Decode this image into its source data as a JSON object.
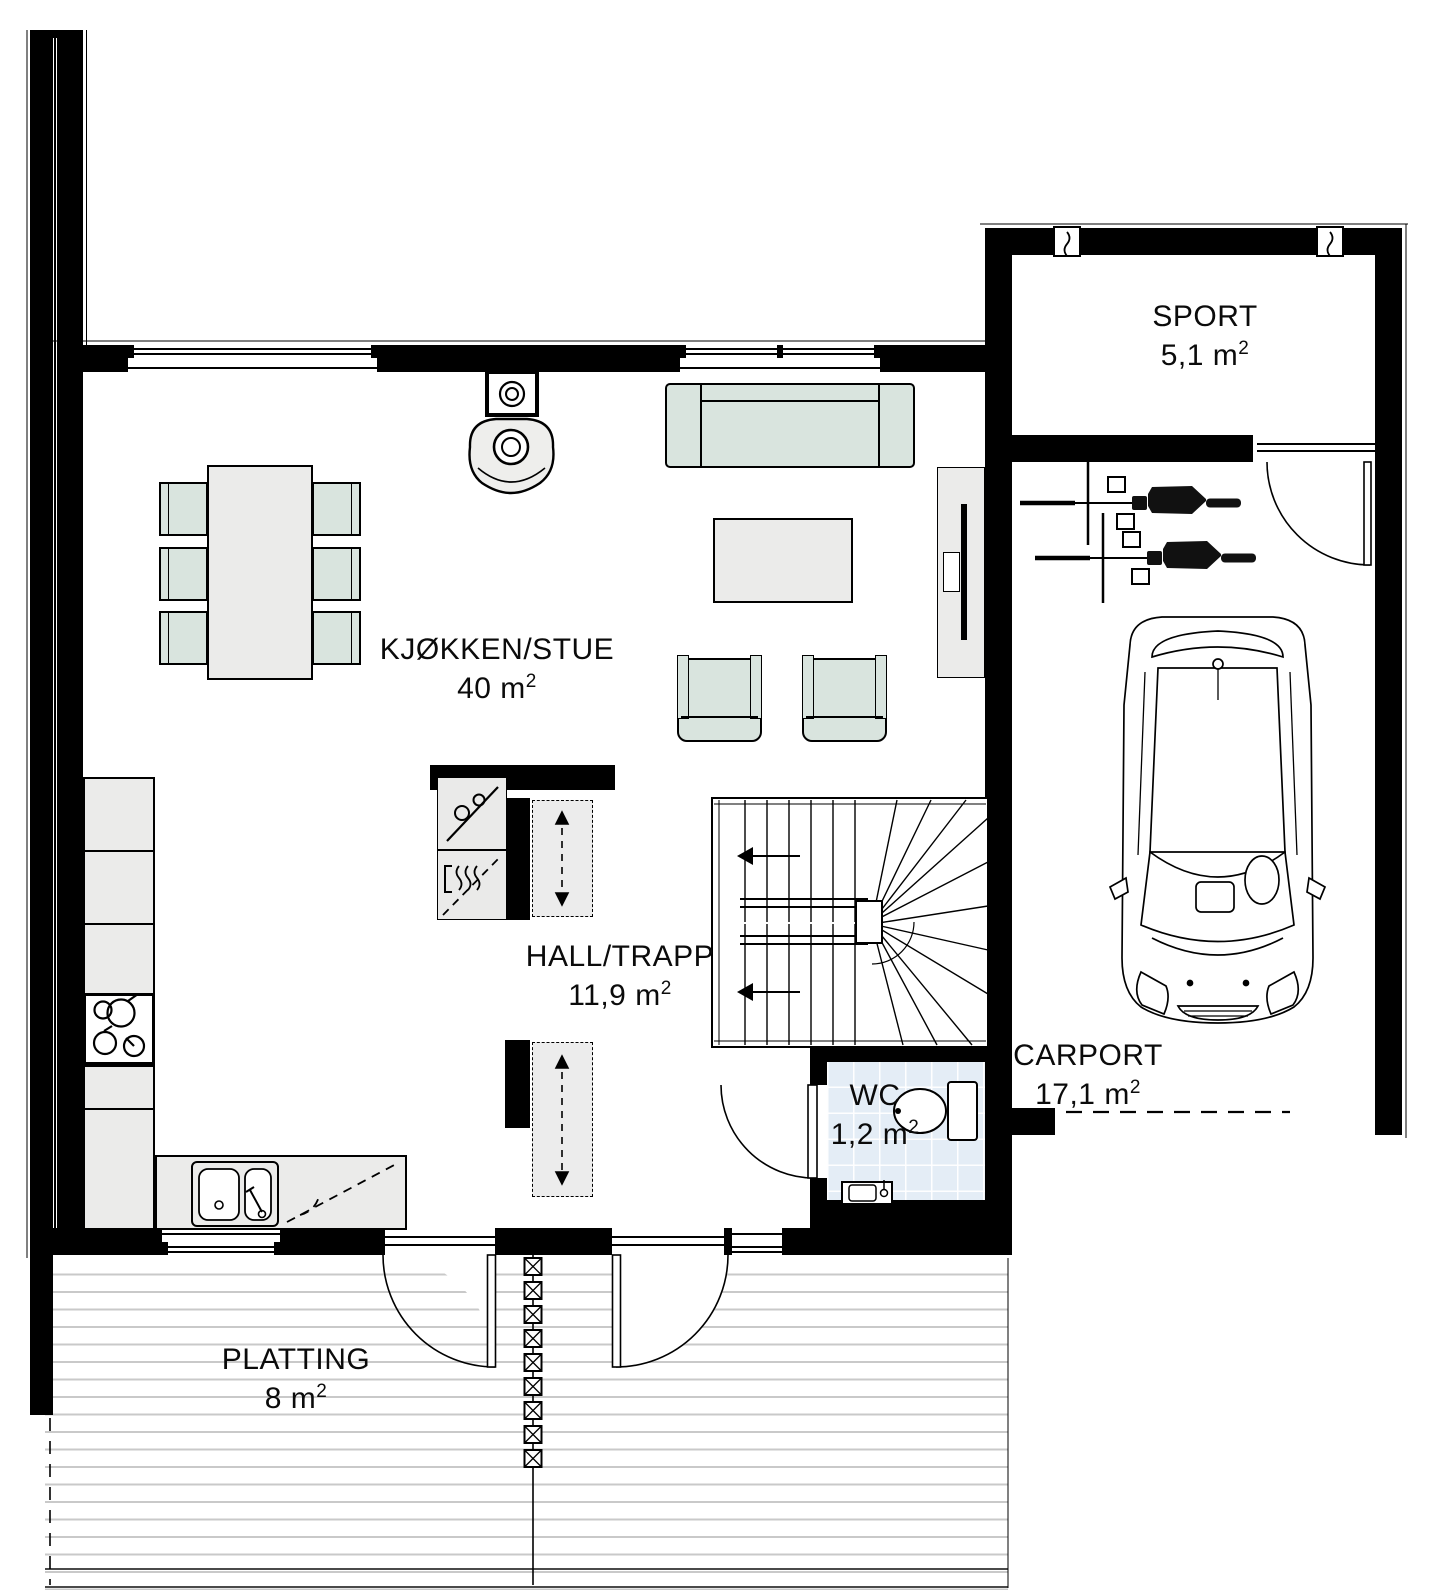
{
  "rooms": [
    {
      "key": "kitchen_living",
      "label": "KJØKKEN/STUE",
      "area": "40 m",
      "sup": "2"
    },
    {
      "key": "hall",
      "label": "HALL/TRAPP",
      "area": "11,9 m",
      "sup": "2"
    },
    {
      "key": "wc",
      "label": "WC",
      "area": "1,2 m",
      "sup": "2"
    },
    {
      "key": "sport",
      "label": "SPORT",
      "area": "5,1 m",
      "sup": "2"
    },
    {
      "key": "carport",
      "label": "CARPORT",
      "area": "17,1 m",
      "sup": "2"
    },
    {
      "key": "platting",
      "label": "PLATTING",
      "area": "8 m",
      "sup": "2"
    }
  ],
  "colors": {
    "wall": "#000000",
    "soft_furniture": "#d9e4de",
    "hard_furniture": "#ebebea",
    "wc_tile": "#e4edf6",
    "deck_line": "#c9c9c9",
    "text": "#0b0b0b"
  }
}
